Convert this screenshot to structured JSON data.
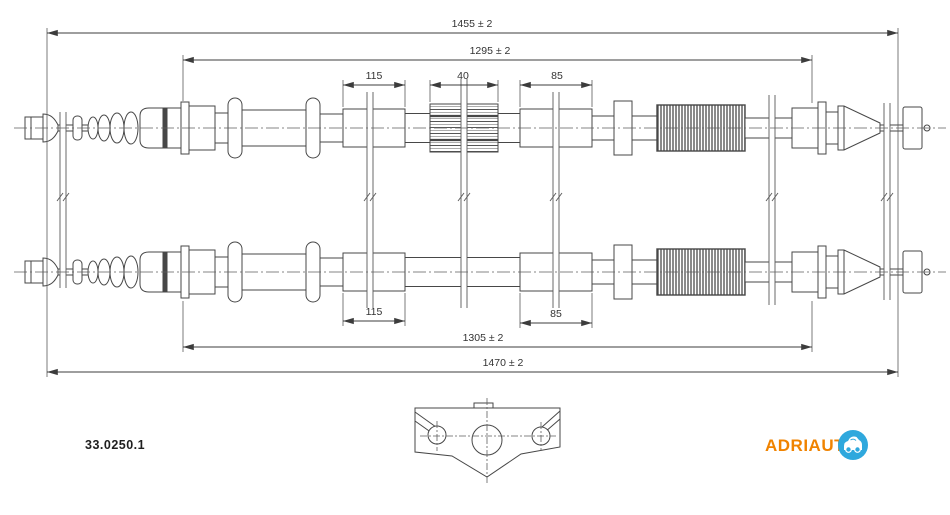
{
  "meta": {
    "part_number": "33.0250.1"
  },
  "dimensions": {
    "top_overall": "1455 ± 2",
    "top_inner": "1295 ± 2",
    "top_seg_115": "115",
    "top_seg_40": "40",
    "top_seg_85": "85",
    "bottom_seg_115": "115",
    "bottom_seg_85": "85",
    "bottom_inner": "1305 ± 2",
    "bottom_overall": "1470 ± 2"
  },
  "logo": {
    "text": "ADRIAUT",
    "text_color": "#F08300",
    "badge_color": "#2FA8DD"
  },
  "colors": {
    "background": "#FFFFFF",
    "line": "#474747",
    "dim_line": "#3C3C3C",
    "text": "#333333"
  }
}
